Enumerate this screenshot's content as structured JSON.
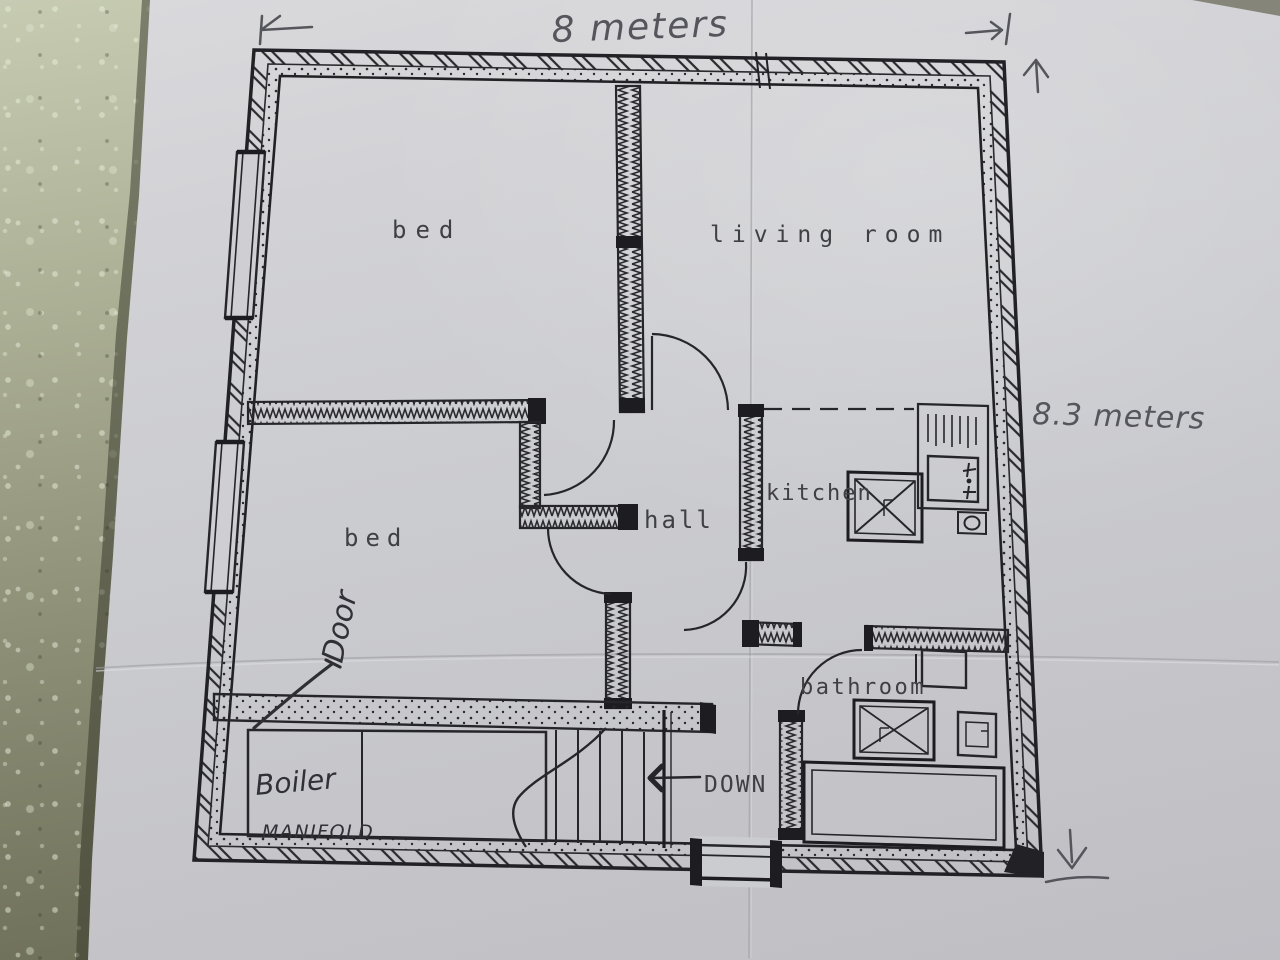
{
  "plan": {
    "dimensions": {
      "width": "8 meters",
      "height": "8.3 meters"
    },
    "rooms": {
      "bed_top": "bed",
      "living": "living room",
      "bed_bottom": "bed",
      "hall": "hall",
      "kitchen": "kitchen",
      "bathroom": "bathroom"
    },
    "labels": {
      "down": "DOWN",
      "door": "Door",
      "boiler": "Boiler",
      "manifold": "MANIFOLD"
    }
  }
}
